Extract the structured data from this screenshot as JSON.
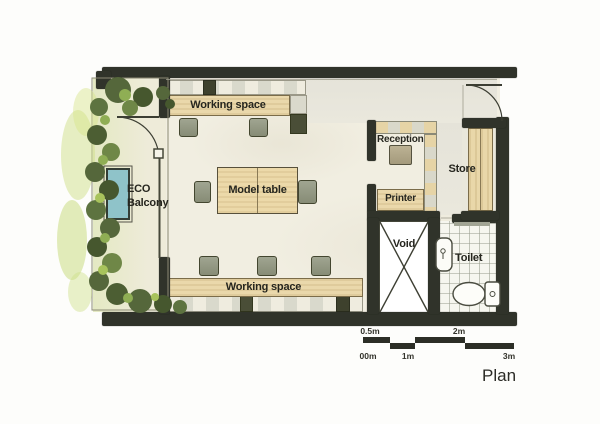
{
  "plan_label": "Plan",
  "rooms": {
    "working_space_top": "Working space",
    "model_table": "Model table",
    "working_space_bottom": "Working space",
    "eco_line1": "ECO",
    "eco_line2": "Balcony",
    "reception": "Reception",
    "printer": "Printer",
    "store": "Store",
    "void": "Void",
    "toilet": "Toilet"
  },
  "scale_bar": {
    "above": {
      "half": "0.5m",
      "two": "2m"
    },
    "below": {
      "zero": "00m",
      "one": "1m",
      "three": "3m"
    }
  },
  "colors": {
    "wall": "#30332a",
    "wood": "#ead8ab",
    "chair": "#969b85",
    "floor": "#f1eee1",
    "plant_dark": "#4c5e33",
    "plant_light": "#8fae54",
    "plant_wash": "#cfe08a",
    "planter_teal": "#8fc3c9",
    "text": "#26261f"
  },
  "icons": {
    "void_cross": "void-cross-icon",
    "sink": "sink-icon",
    "toilet_fixture": "toilet-icon",
    "door_arc": "door-swing-icon",
    "plants": "plants-icon"
  }
}
